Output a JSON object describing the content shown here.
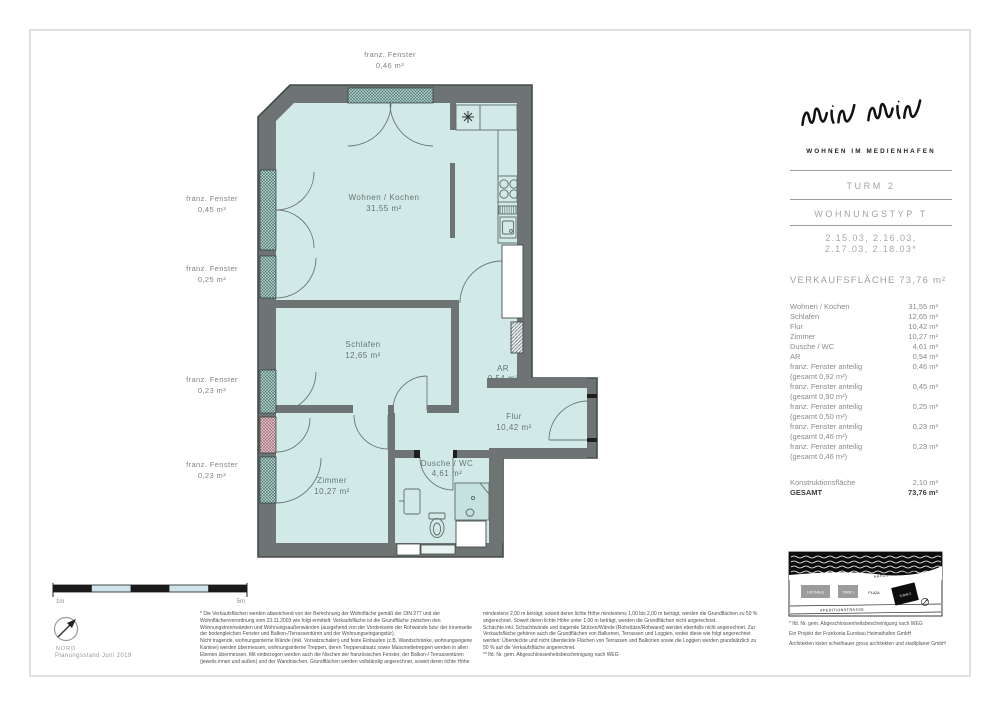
{
  "plan": {
    "rooms": [
      {
        "name": "Wohnen / Kochen",
        "area": "31,55 m²"
      },
      {
        "name": "Schlafen",
        "area": "12,65 m²"
      },
      {
        "name": "Zimmer",
        "area": "10,27 m²"
      },
      {
        "name": "Dusche / WC",
        "area": "4,61 m²"
      },
      {
        "name": "AR",
        "area": "0,54 m²"
      },
      {
        "name": "Flur",
        "area": "10,42 m²"
      }
    ],
    "window_labels": [
      {
        "name": "franz. Fenster",
        "area": "0,46 m²"
      },
      {
        "name": "franz. Fenster",
        "area": "0,45 m²"
      },
      {
        "name": "franz. Fenster",
        "area": "0,25 m²"
      },
      {
        "name": "franz. Fenster",
        "area": "0,23 m²"
      },
      {
        "name": "franz. Fenster",
        "area": "0,23 m²"
      }
    ],
    "colors": {
      "wall": "#6d7473",
      "floor": "#d2eae7",
      "window_hatch": "#47706a",
      "window_hatch_pink": "#9b6470",
      "scalebar_light": "#cfe3eb"
    }
  },
  "scale_bar": {
    "left_label": "1m",
    "right_label": "5m"
  },
  "compass": {
    "label": "NORD"
  },
  "plan_status": "Planungsstand Juni 2019",
  "title_block": {
    "tagline": "WOHNEN IM MEDIENHAFEN",
    "tower": "TURM 2",
    "unit_type": "WOHNUNGSTYP T",
    "unit_numbers_line1": "2.15.03, 2.16.03,",
    "unit_numbers_line2": "2.17.03, 2.18.03*",
    "sales_area": "VERKAUFSFLÄCHE 73,76 m²"
  },
  "area_table": {
    "rows": [
      {
        "label": "Wohnen / Kochen",
        "value": "31,55 m²"
      },
      {
        "label": "Schlafen",
        "value": "12,65 m²"
      },
      {
        "label": "Flur",
        "value": "10,42 m²"
      },
      {
        "label": "Zimmer",
        "value": "10,27 m²"
      },
      {
        "label": "Dusche / WC",
        "value": "4,61 m²"
      },
      {
        "label": "AR",
        "value": "0,54 m²"
      },
      {
        "label": "franz. Fenster anteilig",
        "sublabel": "(gesamt 0,92 m²)",
        "value": "0,46 m²"
      },
      {
        "label": "franz. Fenster anteilig",
        "sublabel": "(gesamt 0,90 m²)",
        "value": "0,45 m²"
      },
      {
        "label": "franz. Fenster anteilig",
        "sublabel": "(gesamt 0,50 m²)",
        "value": "0,25 m²"
      },
      {
        "label": "franz. Fenster anteilig",
        "sublabel": "(gesamt 0,46 m²)",
        "value": "0,23 m²"
      },
      {
        "label": "franz. Fenster anteilig",
        "sublabel": "(gesamt 0,46 m²)",
        "value": "0,23 m²"
      }
    ],
    "construction_row": {
      "label": "Konstruktionsfläche",
      "value": "2,10 m²"
    },
    "total_row": {
      "label": "GESAMT",
      "value": "73,76 m²"
    }
  },
  "site_map": {
    "promenade": "HAFENPROMENADE",
    "street": "SPEDITIONSTRASSE",
    "buildings": [
      {
        "label": "LOFTHAUS"
      },
      {
        "label": "TURM 1"
      },
      {
        "label": "PLAZA"
      },
      {
        "label": "TURM 2"
      }
    ]
  },
  "footnotes": [
    "* lfd. Nr. gem. Abgeschlossenheitsbescheinigung nach WEG",
    "Ein Projekt der Frankonia Eurobau Heimathafen GmbH",
    "Architekten kister scheithauer gross architekten und stadtplaner GmbH"
  ],
  "fine_print": {
    "left_p1": "* Die Verkaufsflächen werden abweichend von der Berechnung der Wohnfläche gemäß der DIN 277 und der Wohnflächenverordnung vom 23.11.2003 wie folgt ermittelt: Verkaufsfläche ist die Grundfläche zwischen den Wohnungstrennwänden und Wohnungsaußenwänden (ausgehend von der Vorderkante der Rohwände bzw. der Innenseite der bodengleichen Fenster und Balkon-/Terrassentüren und der Wohnungseingangstür).",
    "left_p2": "Nicht tragende, wohnungsinterne Wände (inkl. Vorsatzschalen) und feste Einbauten (z.B. Wandschränke, wohnungseigene Kamine) werden übermessen, wohnungsinterne Treppen, deren Treppenabsatz sowie Maisonettetreppen werden in allen Ebenen übermessen. Mit einbezogen werden auch die Nischen der französischen Fenster, der Balkon-/ Terrassentüren (jeweils innen und außen) und der Wandnischen. Grundflächen werden vollständig angerechnet, soweit deren lichte Höhe",
    "right_p1": "mindestens 2,00 m beträgt; soweit deren lichte Höhe mindestens 1,00 bis 2,00 m beträgt, werden die Grundflächen zu 50 % angerechnet. Soweit deren lichte Höhe unter 1,00 m beträgt, werden die Grundflächen nicht angerechnet.",
    "right_p2": "Schächte inkl. Schachtwände und tragende Stützen/Wände (Rohstütze/Rohwand) werden ebenfalls nicht angerechnet. Zur Verkaufsfläche gehören auch die Grundflächen von Balkonen, Terrassen und Loggien, wobei diese wie folgt angerechnet werden: Überdeckte und nicht überdeckte Flächen von Terrassen und Balkonen sowie die Loggien werden grundsätzlich zu 50 % auf die Verkaufsfläche angerechnet.",
    "right_note": "** lfd. Nr. gem. Abgeschlossenheitsbescheinigung nach WEG"
  }
}
